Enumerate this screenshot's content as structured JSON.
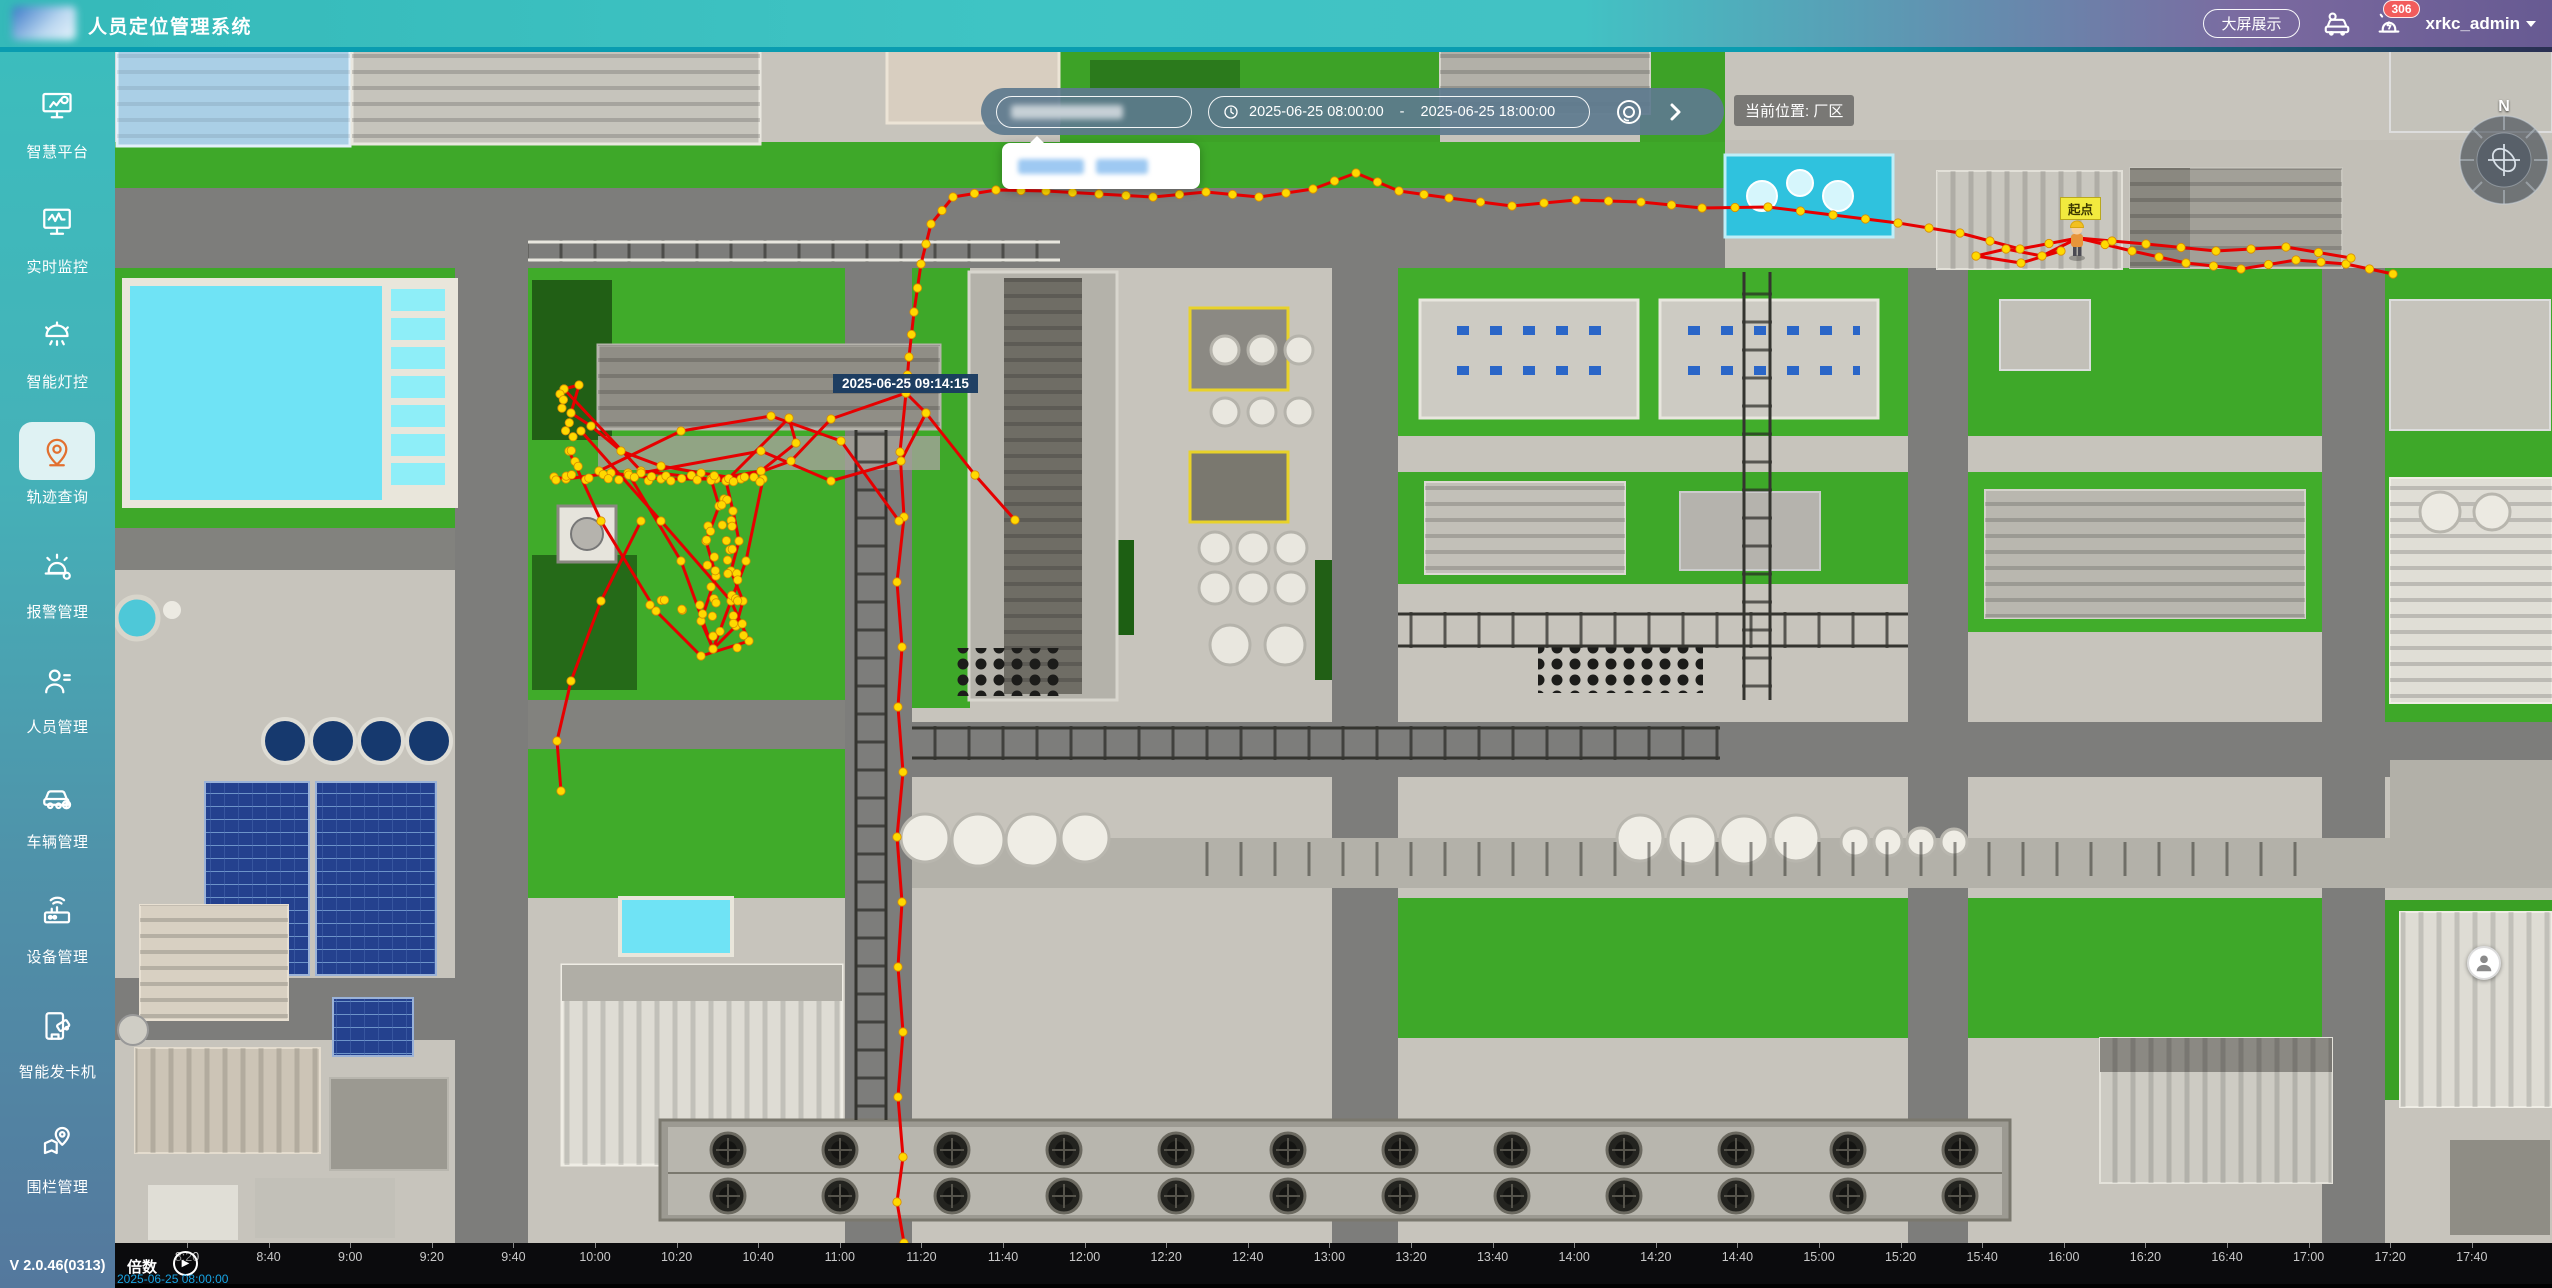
{
  "header": {
    "title": "人员定位管理系统",
    "big_screen_button": "大屏展示",
    "alarm_badge": "306",
    "username": "xrkc_admin"
  },
  "sidebar": {
    "items": [
      {
        "label": "智慧平台",
        "icon": "platform-icon",
        "active": false
      },
      {
        "label": "实时监控",
        "icon": "monitor-icon",
        "active": false
      },
      {
        "label": "智能灯控",
        "icon": "light-icon",
        "active": false
      },
      {
        "label": "轨迹查询",
        "icon": "track-icon",
        "active": true
      },
      {
        "label": "报警管理",
        "icon": "alarm-icon",
        "active": false
      },
      {
        "label": "人员管理",
        "icon": "person-icon",
        "active": false
      },
      {
        "label": "车辆管理",
        "icon": "vehicle-icon",
        "active": false
      },
      {
        "label": "设备管理",
        "icon": "device-icon",
        "active": false
      },
      {
        "label": "智能发卡机",
        "icon": "card-icon",
        "active": false
      },
      {
        "label": "围栏管理",
        "icon": "fence-icon",
        "active": false
      }
    ],
    "version": "V 2.0.46(0313)"
  },
  "toolbar": {
    "date_start": "2025-06-25 08:00:00",
    "date_separator": "-",
    "date_end": "2025-06-25 18:00:00",
    "location_label": "当前位置: 厂区"
  },
  "map": {
    "tooltip_time": "2025-06-25 09:14:15",
    "start_label": "起点",
    "compass_label": "N"
  },
  "timeline": {
    "speed_label": "倍数",
    "current_time": "2025-06-25 08:00:00",
    "ticks": [
      "8:20",
      "8:40",
      "9:00",
      "9:20",
      "9:40",
      "10:00",
      "10:20",
      "10:40",
      "11:00",
      "11:20",
      "11:40",
      "12:00",
      "12:20",
      "12:40",
      "13:00",
      "13:20",
      "13:40",
      "14:00",
      "14:20",
      "14:40",
      "15:00",
      "15:20",
      "15:40",
      "16:00",
      "16:20",
      "16:40",
      "17:00",
      "17:20",
      "17:40"
    ],
    "first_tick_x": 72,
    "tick_spacing": 81.6
  },
  "trajectory": {
    "line_color": "#e60000",
    "dot_color": "#ffd900",
    "paths": [
      {
        "dense": true,
        "pts": [
          [
            2078,
            238
          ],
          [
            2020,
            249
          ],
          [
            1960,
            233
          ],
          [
            1898,
            223
          ],
          [
            1833,
            215
          ],
          [
            1768,
            207
          ],
          [
            1702,
            208
          ],
          [
            1641,
            202
          ],
          [
            1576,
            200
          ],
          [
            1512,
            206
          ],
          [
            1449,
            198
          ],
          [
            1399,
            191
          ],
          [
            1356,
            173
          ],
          [
            1313,
            189
          ],
          [
            1259,
            197
          ],
          [
            1206,
            192
          ],
          [
            1153,
            197
          ],
          [
            1099,
            194
          ],
          [
            1046,
            191
          ],
          [
            996,
            190
          ],
          [
            953,
            197
          ],
          [
            931,
            224
          ],
          [
            921,
            264
          ],
          [
            914,
            312
          ],
          [
            909,
            357
          ],
          [
            906,
            393
          ]
        ]
      },
      {
        "dense": true,
        "pts": [
          [
            2078,
            238
          ],
          [
            2132,
            251
          ],
          [
            2186,
            263
          ],
          [
            2241,
            269
          ],
          [
            2296,
            260
          ],
          [
            2346,
            264
          ],
          [
            2393,
            274
          ]
        ]
      },
      {
        "dense": true,
        "pts": [
          [
            2078,
            238
          ],
          [
            2146,
            244
          ],
          [
            2216,
            251
          ],
          [
            2286,
            247
          ],
          [
            2351,
            258
          ]
        ]
      },
      {
        "dense": false,
        "pts": [
          [
            2078,
            238
          ],
          [
            2042,
            256
          ],
          [
            2006,
            249
          ],
          [
            1976,
            256
          ],
          [
            2021,
            263
          ],
          [
            2061,
            251
          ]
        ]
      },
      {
        "dense": false,
        "pts": [
          [
            906,
            393
          ],
          [
            900,
            452
          ],
          [
            904,
            517
          ],
          [
            897,
            582
          ],
          [
            902,
            647
          ],
          [
            898,
            707
          ],
          [
            903,
            772
          ],
          [
            897,
            837
          ],
          [
            902,
            902
          ],
          [
            898,
            967
          ],
          [
            903,
            1032
          ],
          [
            898,
            1097
          ],
          [
            903,
            1157
          ],
          [
            897,
            1202
          ],
          [
            904,
            1243
          ]
        ]
      },
      {
        "dense": false,
        "pts": [
          [
            564,
            389
          ],
          [
            579,
            385
          ],
          [
            571,
            413
          ],
          [
            591,
            426
          ],
          [
            621,
            451
          ],
          [
            661,
            466
          ],
          [
            701,
            473
          ],
          [
            741,
            479
          ],
          [
            791,
            461
          ],
          [
            831,
            419
          ],
          [
            906,
            393
          ]
        ]
      },
      {
        "dense": false,
        "pts": [
          [
            564,
            389
          ],
          [
            641,
            471
          ],
          [
            726,
            481
          ],
          [
            789,
            418
          ],
          [
            796,
            443
          ],
          [
            761,
            471
          ],
          [
            716,
            479
          ],
          [
            661,
            479
          ],
          [
            611,
            473
          ],
          [
            566,
            479
          ],
          [
            554,
            477
          ]
        ]
      },
      {
        "dense": false,
        "pts": [
          [
            726,
            481
          ],
          [
            733,
            511
          ],
          [
            739,
            541
          ],
          [
            731,
            571
          ],
          [
            743,
            601
          ],
          [
            736,
            626
          ],
          [
            713,
            649
          ],
          [
            701,
            621
          ],
          [
            716,
            576
          ],
          [
            706,
            541
          ],
          [
            719,
            506
          ],
          [
            711,
            479
          ]
        ]
      },
      {
        "dense": false,
        "pts": [
          [
            628,
            473
          ],
          [
            681,
            561
          ],
          [
            713,
            649
          ],
          [
            746,
            561
          ],
          [
            763,
            479
          ]
        ]
      },
      {
        "dense": false,
        "pts": [
          [
            581,
            431
          ],
          [
            661,
            521
          ],
          [
            731,
            601
          ],
          [
            749,
            641
          ],
          [
            701,
            656
          ],
          [
            656,
            611
          ],
          [
            601,
            521
          ],
          [
            569,
            451
          ]
        ]
      },
      {
        "dense": false,
        "pts": [
          [
            641,
            473
          ],
          [
            761,
            451
          ],
          [
            831,
            481
          ],
          [
            901,
            461
          ],
          [
            926,
            413
          ],
          [
            906,
            393
          ]
        ]
      },
      {
        "dense": false,
        "pts": [
          [
            599,
            471
          ],
          [
            681,
            431
          ],
          [
            771,
            416
          ],
          [
            841,
            441
          ],
          [
            899,
            521
          ]
        ]
      },
      {
        "dense": false,
        "pts": [
          [
            641,
            521
          ],
          [
            601,
            601
          ],
          [
            571,
            681
          ],
          [
            557,
            741
          ],
          [
            561,
            791
          ]
        ]
      },
      {
        "dense": false,
        "pts": [
          [
            926,
            413
          ],
          [
            975,
            475
          ],
          [
            1015,
            520
          ]
        ]
      }
    ],
    "dot_bands": [
      {
        "from": [
          556,
          477
        ],
        "to": [
          762,
          479
        ],
        "count": 24,
        "jitter": 3
      },
      {
        "from": [
          724,
          494
        ],
        "to": [
          740,
          643
        ],
        "count": 21,
        "jitter": 5
      },
      {
        "from": [
          708,
          522
        ],
        "to": [
          717,
          638
        ],
        "count": 12,
        "jitter": 4
      },
      {
        "from": [
          560,
          391
        ],
        "to": [
          577,
          469
        ],
        "count": 9,
        "jitter": 3
      },
      {
        "from": [
          650,
          600
        ],
        "to": [
          705,
          612
        ],
        "count": 7,
        "jitter": 5
      }
    ]
  }
}
